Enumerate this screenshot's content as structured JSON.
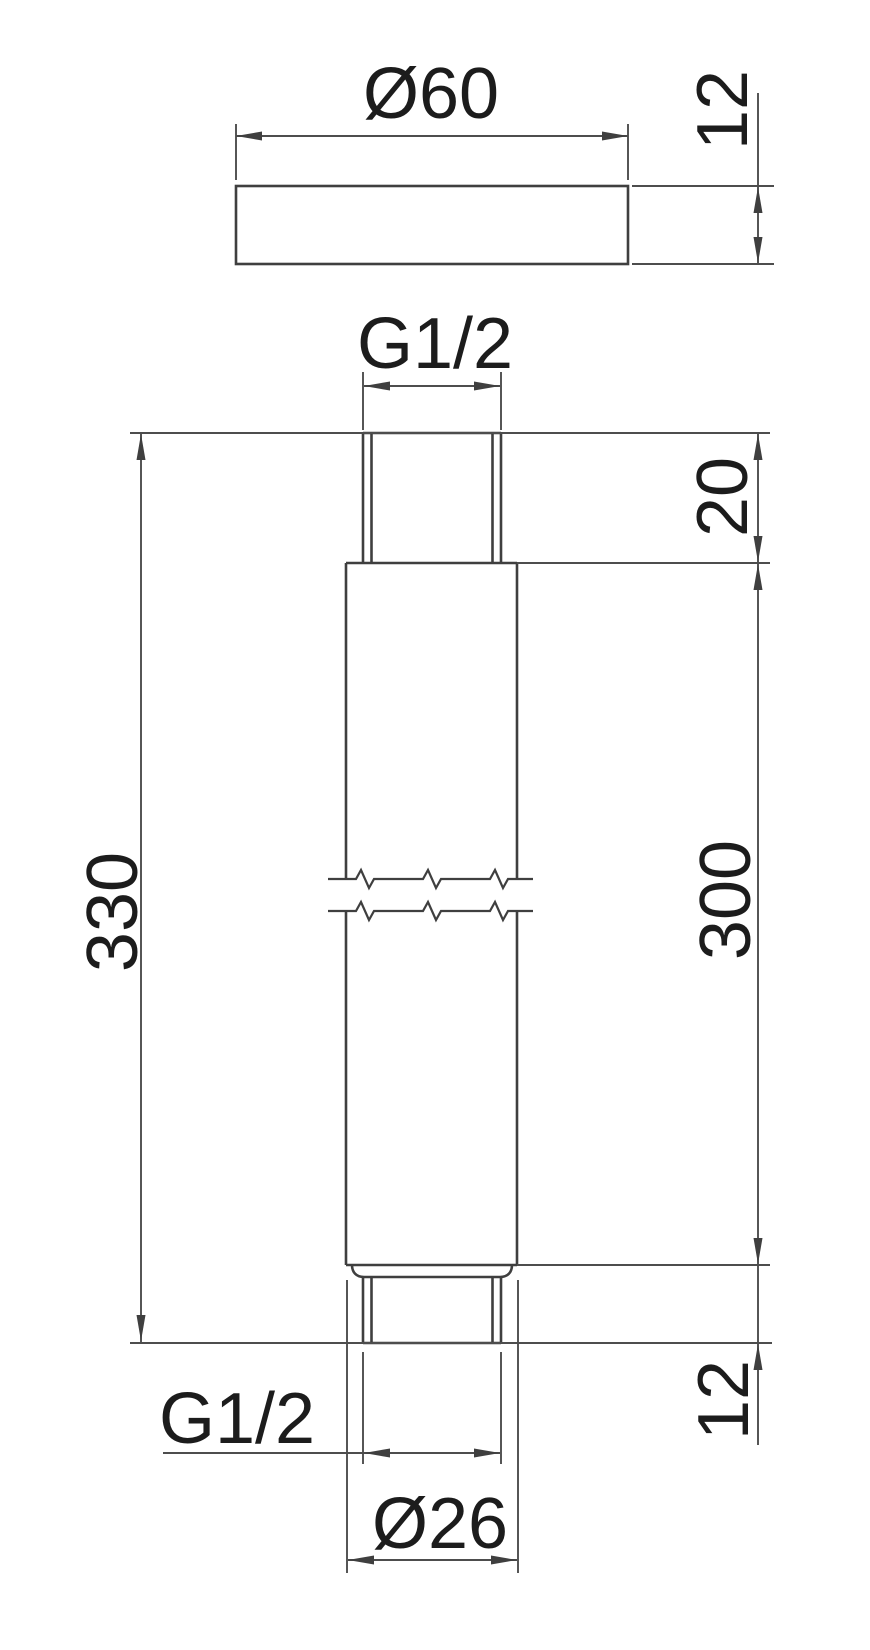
{
  "drawing": {
    "kind": "technical-dimension-drawing",
    "background": "#ffffff",
    "line_color": "#3f3f3f",
    "dimension_line_color": "#4d4d4d",
    "text_color": "#1c1c1c",
    "flange_side_view": {
      "diameter": "Ø60",
      "thickness": "12"
    },
    "pipe_front_view": {
      "top_thread": "G1/2",
      "top_thread_length": "20",
      "overall_length": "330",
      "body_length": "300",
      "bottom_thread_length": "12",
      "bottom_thread": "G1/2",
      "pipe_diameter": "Ø26"
    }
  }
}
